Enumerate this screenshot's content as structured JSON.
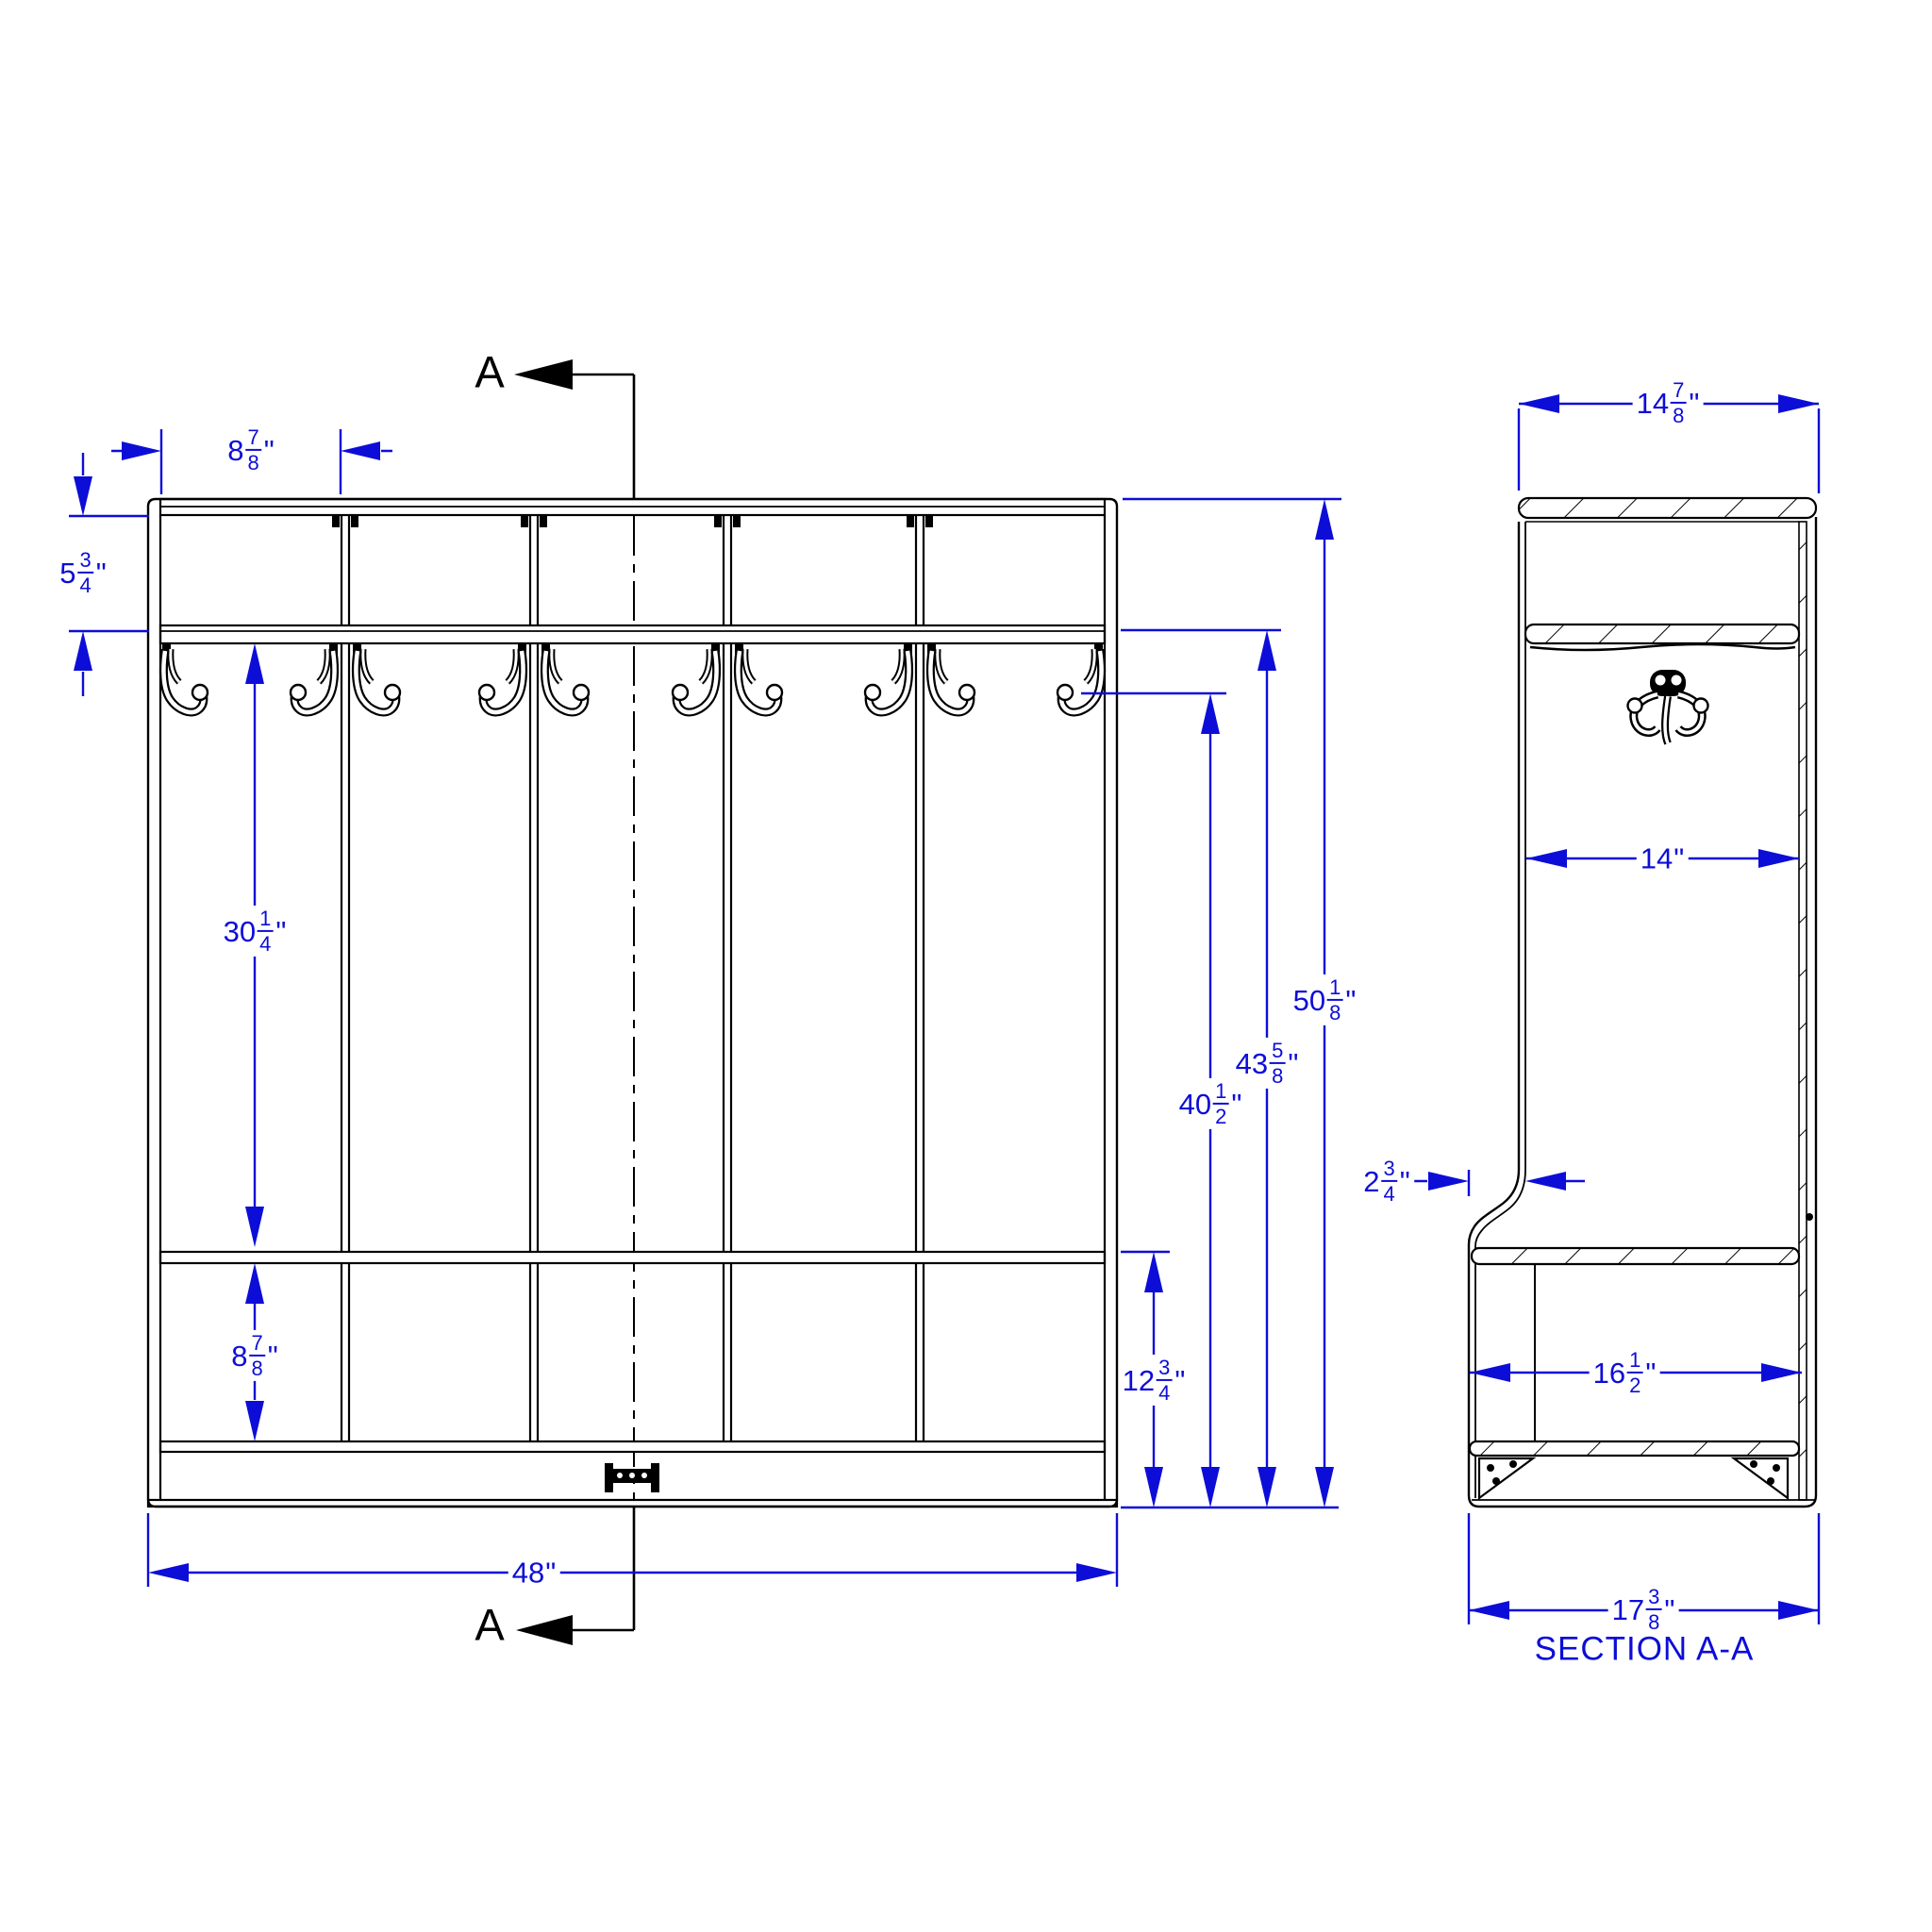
{
  "colors": {
    "dimension_blue": "#0d0dd8",
    "drawing_black": "#000000",
    "background": "#ffffff"
  },
  "labels": {
    "inch_mark": "\"",
    "section_marker": "A",
    "section_title": "SECTION A-A"
  },
  "dims": {
    "bay_width": {
      "w": "8",
      "n": "7",
      "d": "8"
    },
    "top_rail_to_shelf": {
      "w": "5",
      "n": "3",
      "d": "4"
    },
    "shelf_to_bench": {
      "w": "30",
      "n": "1",
      "d": "4"
    },
    "bench_to_lower": {
      "w": "8",
      "n": "7",
      "d": "8"
    },
    "overall_width": {
      "w": "48"
    },
    "floor_to_bench": {
      "w": "12",
      "n": "3",
      "d": "4"
    },
    "floor_to_hook": {
      "w": "40",
      "n": "1",
      "d": "2"
    },
    "floor_to_shelf": {
      "w": "43",
      "n": "5",
      "d": "8"
    },
    "overall_height": {
      "w": "50",
      "n": "1",
      "d": "8"
    },
    "top_depth": {
      "w": "14",
      "n": "7",
      "d": "8"
    },
    "inner_depth": {
      "w": "14"
    },
    "bench_front_offset": {
      "w": "2",
      "n": "3",
      "d": "4"
    },
    "bench_inner_depth": {
      "w": "16",
      "n": "1",
      "d": "2"
    },
    "overall_depth": {
      "w": "17",
      "n": "3",
      "d": "8"
    }
  }
}
